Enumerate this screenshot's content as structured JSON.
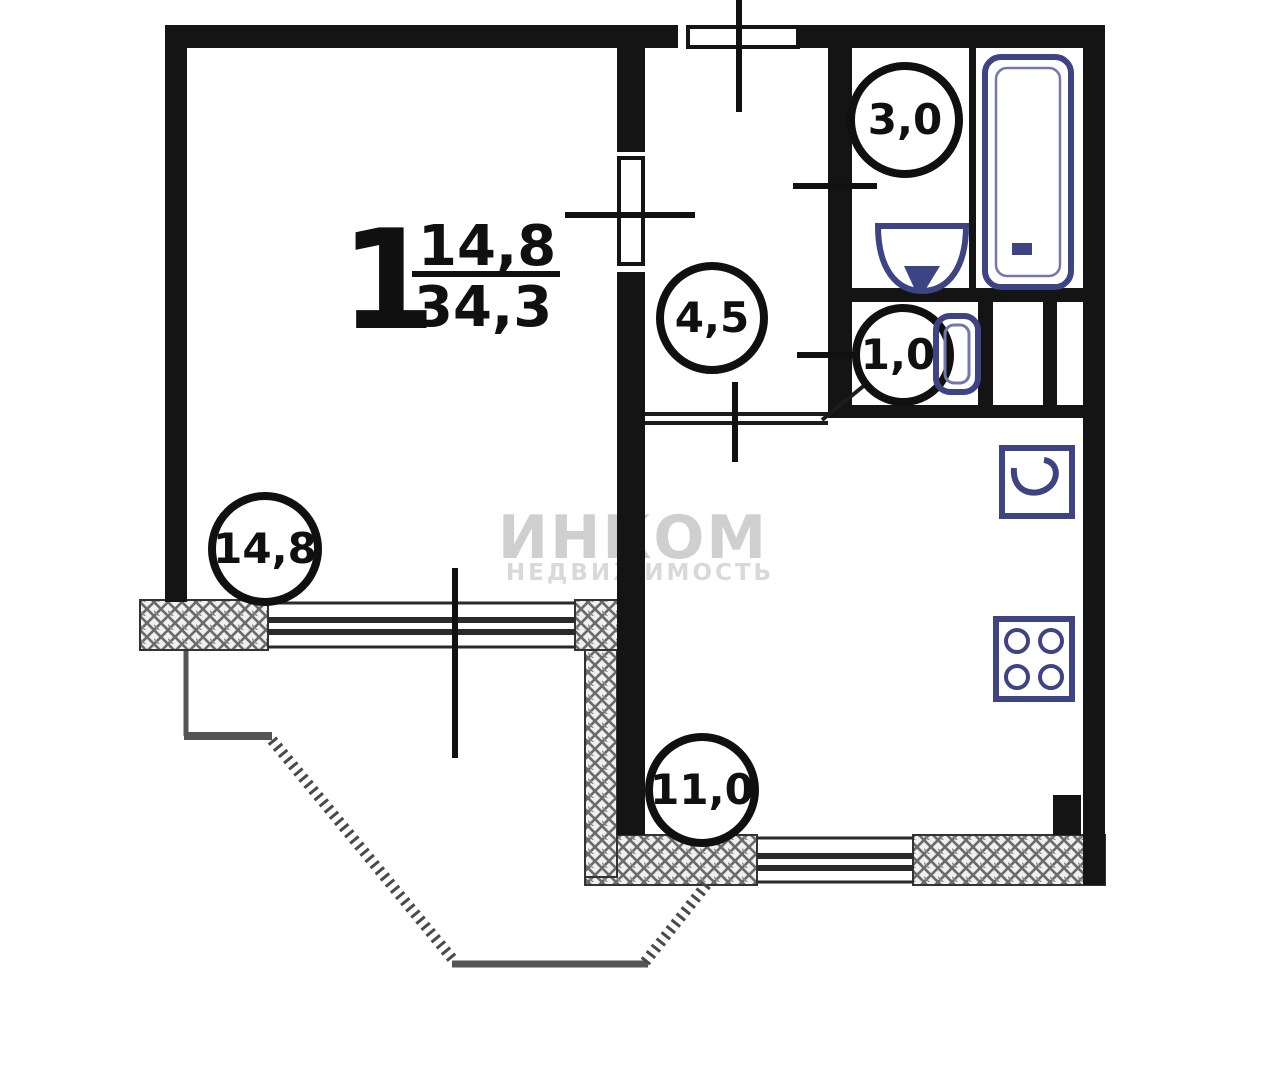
{
  "apartment_label": {
    "rooms": "1",
    "living_area": "14,8",
    "total_area": "34,3"
  },
  "badges": [
    {
      "room": "bathroom",
      "area": "3,0"
    },
    {
      "room": "hallway",
      "area": "4,5"
    },
    {
      "room": "wc",
      "area": "1,0"
    },
    {
      "room": "living-room",
      "area": "14,8"
    },
    {
      "room": "kitchen",
      "area": "11,0"
    }
  ],
  "watermark": {
    "brand": "ИНКОМ",
    "subtitle": "НЕДВИЖИМОСТЬ"
  },
  "colors": {
    "wall": "#141414",
    "fixture": "#3d4383",
    "hatch": "#6b6b6b",
    "watermark": "#cfcfcf"
  }
}
